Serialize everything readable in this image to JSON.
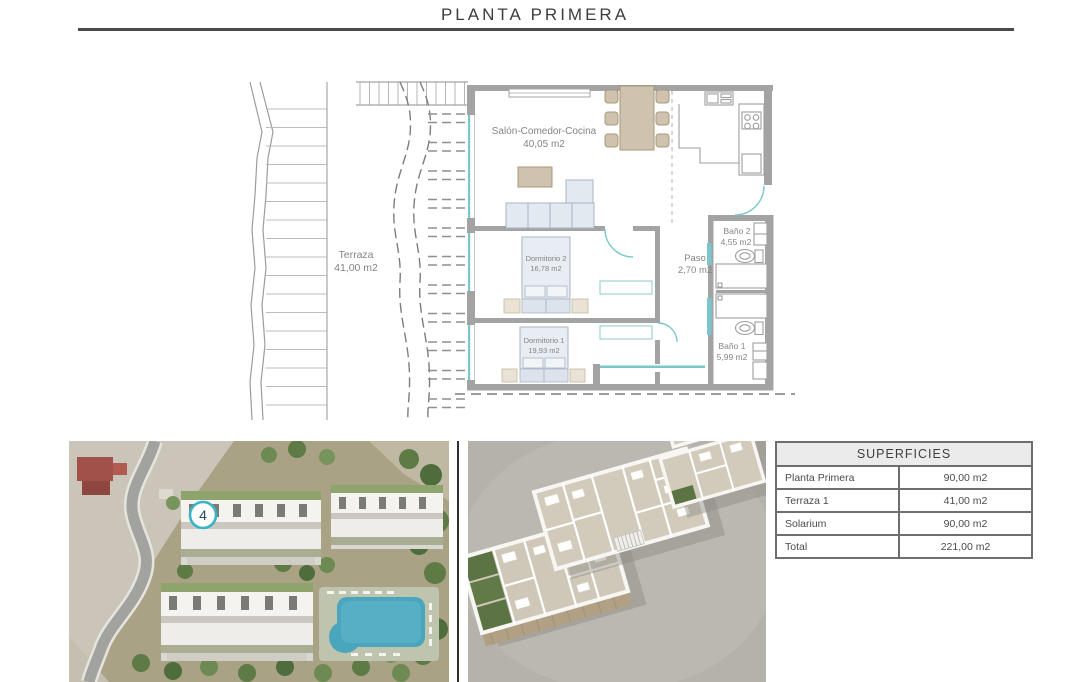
{
  "header": {
    "title": "PLANTA PRIMERA"
  },
  "colors": {
    "accent_teal": "#3bb3c6",
    "plan_teal": "#79c7cd",
    "wall_gray": "#a3a3a3",
    "furniture_tan": "#cfc2ae",
    "furniture_blue": "#e3e9f1",
    "table_header_bg": "#ebebeb"
  },
  "floor_plan": {
    "rooms": [
      {
        "name": "Terraza",
        "area": "41,00 m2"
      },
      {
        "name": "Salón-Comedor-Cocina",
        "area": "40,05 m2"
      },
      {
        "name": "Dormitorio 2",
        "area": "16,78 m2"
      },
      {
        "name": "Dormitorio 1",
        "area": "19,93 m2"
      },
      {
        "name": "Baño 2",
        "area": "4,55 m2"
      },
      {
        "name": "Paso",
        "area": "2,70 m2"
      },
      {
        "name": "Baño 1",
        "area": "5,99 m2"
      }
    ]
  },
  "site_render": {
    "unit_marker": "4"
  },
  "surfaces_table": {
    "title": "SUPERFICIES",
    "rows": [
      {
        "label": "Planta Primera",
        "value": "90,00 m2"
      },
      {
        "label": "Terraza 1",
        "value": "41,00 m2"
      },
      {
        "label": "Solarium",
        "value": "90,00 m2"
      },
      {
        "label": "Total",
        "value": "221,00 m2"
      }
    ]
  }
}
